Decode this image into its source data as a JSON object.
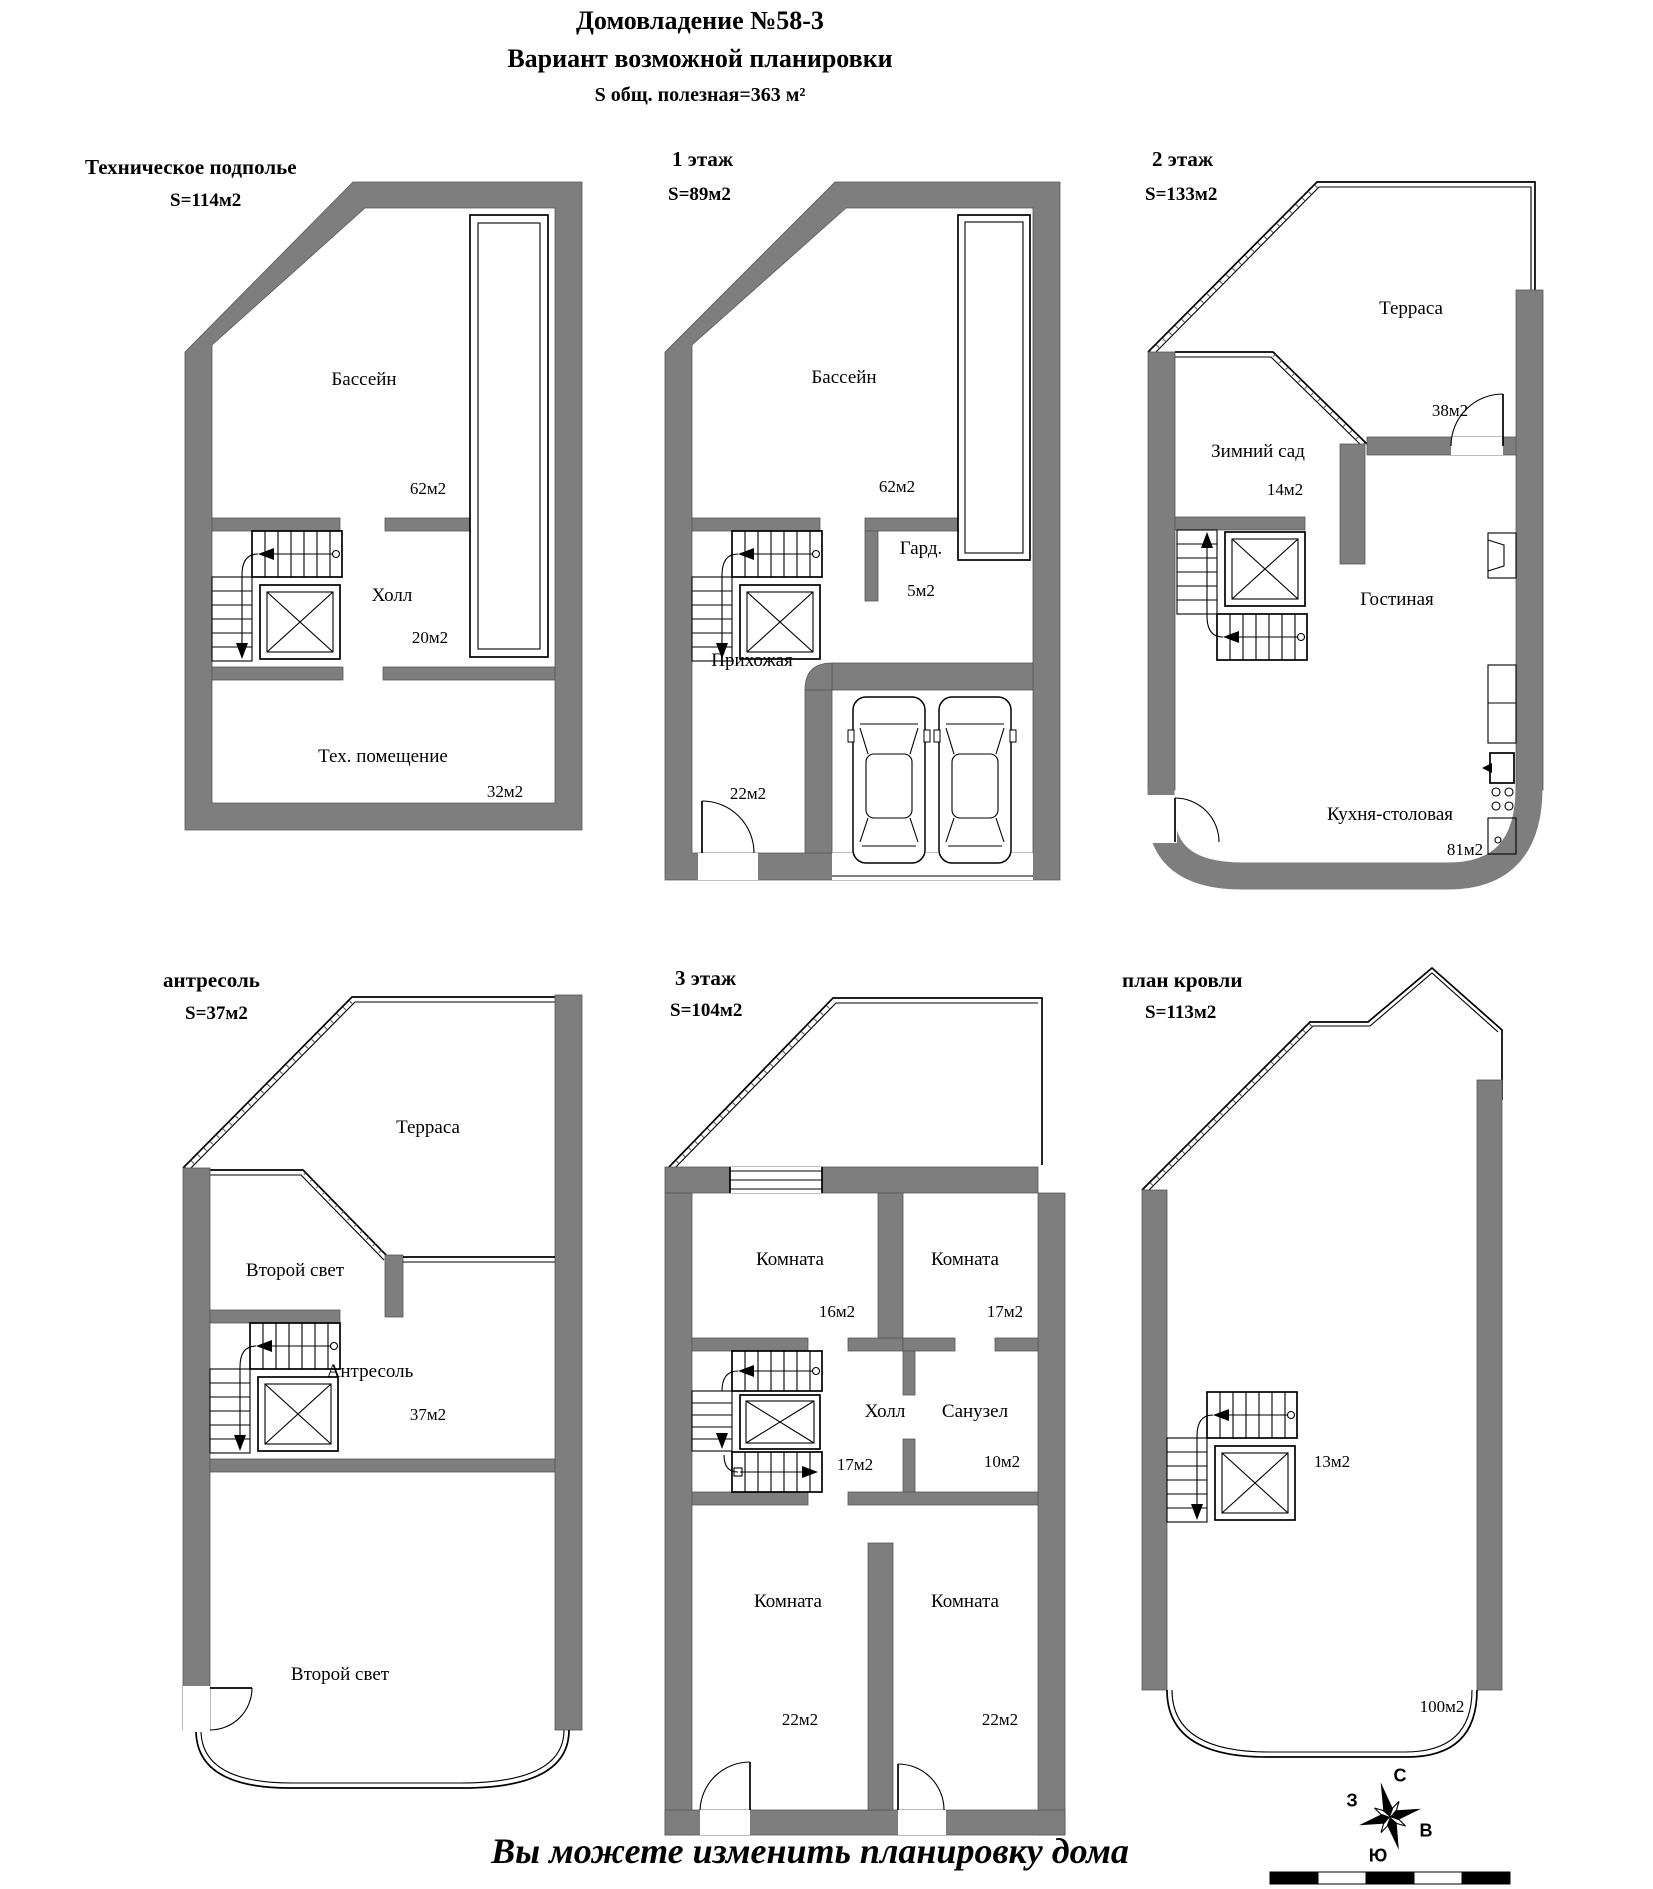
{
  "header": {
    "title": "Домовладение №58-3",
    "subtitle": "Вариант возможной планировки",
    "total_area": "S общ. полезная=363 м²"
  },
  "plans": {
    "basement": {
      "title": "Техническое подполье",
      "area_label": "S=114м2",
      "rooms": {
        "pool": "Бассейн",
        "pool_area": "62м2",
        "hall": "Холл",
        "hall_area": "20м2",
        "tech_room": "Тех. помещение",
        "tech_room_area": "32м2"
      }
    },
    "floor1": {
      "title": "1 этаж",
      "area_label": "S=89м2",
      "rooms": {
        "pool": "Бассейн",
        "pool_area": "62м2",
        "wardrobe": "Гард.",
        "wardrobe_area": "5м2",
        "entrance_hall": "Прихожая",
        "entrance_hall_area": "22м2"
      }
    },
    "floor2": {
      "title": "2 этаж",
      "area_label": "S=133м2",
      "rooms": {
        "terrace": "Терраса",
        "terrace_area": "38м2",
        "winter_garden": "Зимний сад",
        "winter_garden_area": "14м2",
        "living_room": "Гостиная",
        "kitchen_dining": "Кухня-столовая",
        "kitchen_dining_area": "81м2"
      }
    },
    "mezzanine": {
      "title": "антресоль",
      "area_label": "S=37м2",
      "rooms": {
        "terrace": "Терраса",
        "void_upper": "Второй свет",
        "mezzanine": "Антресоль",
        "mezzanine_area": "37м2",
        "void_lower": "Второй свет"
      }
    },
    "floor3": {
      "title": "3 этаж",
      "area_label": "S=104м2",
      "rooms": {
        "room_top_left": "Комната",
        "room_top_left_area": "16м2",
        "room_top_right": "Комната",
        "room_top_right_area": "17м2",
        "hall": "Холл",
        "hall_area": "17м2",
        "bathroom": "Санузел",
        "bathroom_area": "10м2",
        "room_bottom_left": "Комната",
        "room_bottom_left_area": "22м2",
        "room_bottom_right": "Комната",
        "room_bottom_right_area": "22м2"
      }
    },
    "roof": {
      "title": "план кровли",
      "area_label": "S=113м2",
      "rooms": {
        "stair_area": "13м2",
        "roof_area": "100м2"
      }
    }
  },
  "footer": {
    "note": "Вы можете изменить планировку дома"
  },
  "compass": {
    "north": "С",
    "south": "Ю",
    "west": "З",
    "east": "В"
  },
  "scale_bar": {
    "segments": 5
  },
  "colors": {
    "wall": "#7e7e7e",
    "line": "#000000",
    "background": "#ffffff"
  }
}
